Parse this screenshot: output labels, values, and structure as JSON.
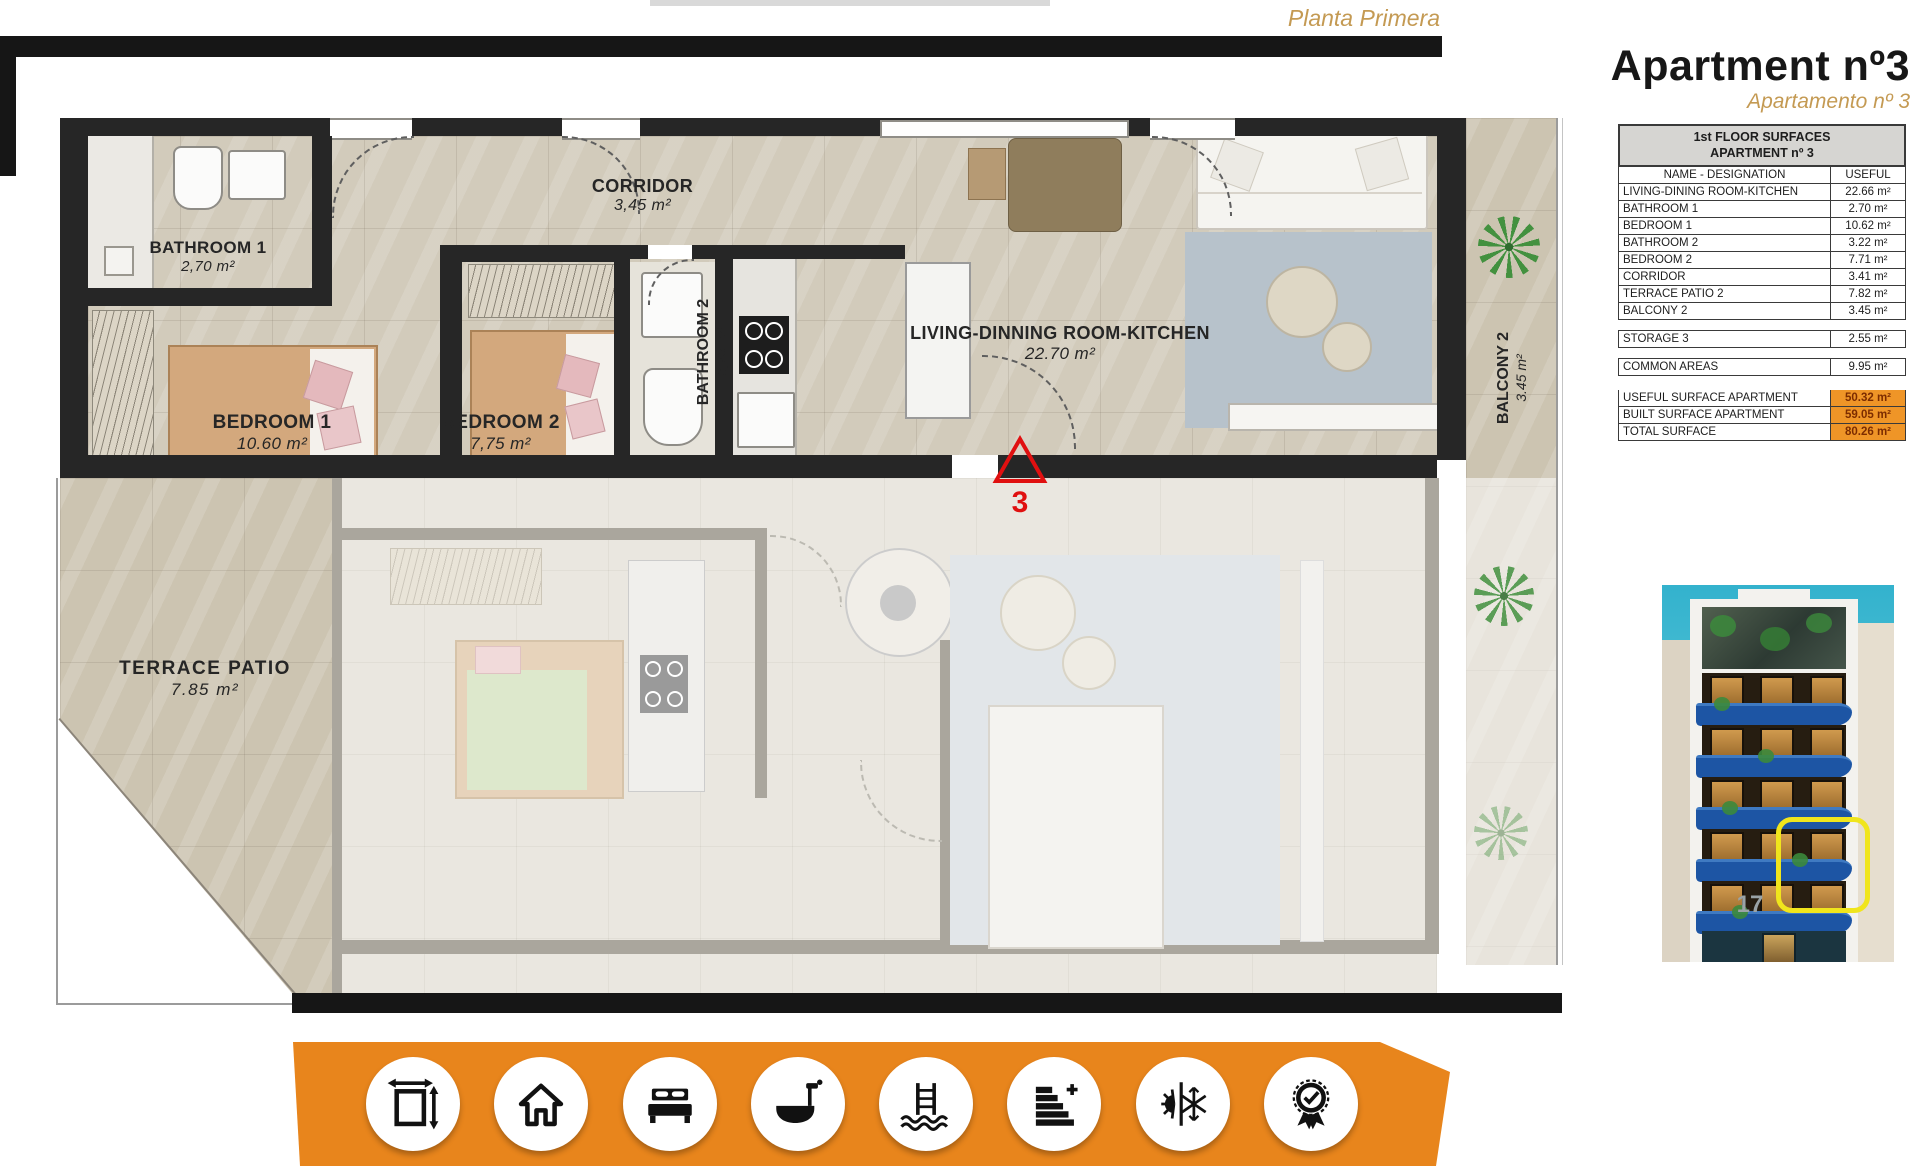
{
  "page": {
    "floor_label": "Planta Primera",
    "title": "Apartment nº3",
    "subtitle": "Apartamento nº 3"
  },
  "surfaces_table": {
    "title_line1": "1st FLOOR SURFACES",
    "title_line2": "APARTMENT nº 3",
    "columns": {
      "name": "NAME - DESIGNATION",
      "useful": "USEFUL"
    },
    "rows": [
      {
        "name": "LIVING-DINING ROOM-KITCHEN",
        "value": "22.66 m²"
      },
      {
        "name": "BATHROOM 1",
        "value": "2.70 m²"
      },
      {
        "name": "BEDROOM 1",
        "value": "10.62 m²"
      },
      {
        "name": "BATHROOM 2",
        "value": "3.22 m²"
      },
      {
        "name": "BEDROOM 2",
        "value": "7.71 m²"
      },
      {
        "name": "CORRIDOR",
        "value": "3.41 m²"
      },
      {
        "name": "TERRACE PATIO 2",
        "value": "7.82 m²"
      },
      {
        "name": "BALCONY 2",
        "value": "3.45 m²"
      }
    ],
    "storage_row": {
      "name": "STORAGE 3",
      "value": "2.55 m²"
    },
    "common_row": {
      "name": "COMMON AREAS",
      "value": "9.95 m²"
    },
    "summary_rows": [
      {
        "name": "USEFUL SURFACE APARTMENT",
        "value": "50.32 m²"
      },
      {
        "name": "BUILT SURFACE APARTMENT",
        "value": "59.05 m²"
      },
      {
        "name": "TOTAL SURFACE",
        "value": "80.26 m²"
      }
    ]
  },
  "floor_plan": {
    "bathroom1": {
      "name": "BATHROOM 1",
      "area": "2,70 m²"
    },
    "bedroom1": {
      "name": "BEDROOM 1",
      "area": "10.60 m²"
    },
    "bedroom2": {
      "name": "BEDROOM 2",
      "area": "7,75 m²"
    },
    "corridor": {
      "name": "CORRIDOR",
      "area": "3,45 m²"
    },
    "bathroom2": {
      "name": "BATHROOM 2",
      "area": "3,25 m²"
    },
    "living": {
      "name": "LIVING-DINNING ROOM-KITCHEN",
      "area": "22.70 m²"
    },
    "balcony2": {
      "name": "BALCONY 2",
      "area": "3.45 m²"
    },
    "terrace": {
      "name": "TERRACE PATIO",
      "area": "7.85 m²"
    },
    "unit_marker": "3"
  },
  "building_photo": {
    "street_number": "17"
  },
  "amenities": [
    "dimensions",
    "house",
    "bedrooms",
    "bathrooms",
    "pool",
    "energy-rating",
    "climate",
    "quality-guarantee"
  ],
  "colors": {
    "accent_orange": "#e8851c",
    "table_highlight": "#ef9527",
    "gold_text": "#c49a53",
    "marker_red": "#e01010",
    "balcony_blue": "#1d55a4",
    "highlight_yellow": "#f0e51c"
  }
}
